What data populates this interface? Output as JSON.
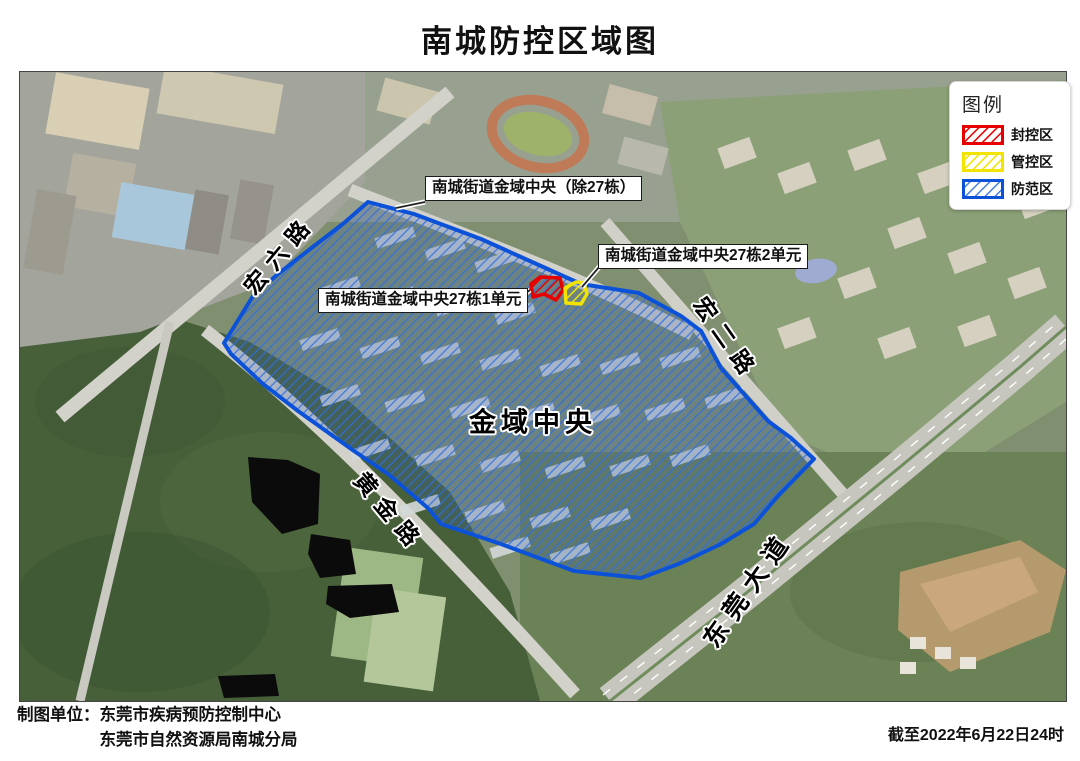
{
  "title": "南城防控区域图",
  "legend": {
    "title": "图例",
    "items": [
      {
        "label": "封控区",
        "color": "#e60000"
      },
      {
        "label": "管控区",
        "color": "#f2e400"
      },
      {
        "label": "防范区",
        "color": "#0b52d8"
      }
    ]
  },
  "map": {
    "callouts": {
      "except27": "南城街道金域中央（除27栋）",
      "b27u2": "南城街道金域中央27栋2单元",
      "b27u1": "南城街道金域中央27栋1单元"
    },
    "roads": {
      "hongliu": "宏六路",
      "honger": "宏二路",
      "huangjin": "黄金路",
      "dongguan": "东莞大道"
    },
    "area": "金域中央"
  },
  "footer": {
    "credit_label": "制图单位：",
    "credit_line1": "东莞市疾病预防控制中心",
    "credit_line2": "东莞市自然资源局南城分局",
    "cutoff": "截至2022年6月22日24时"
  }
}
